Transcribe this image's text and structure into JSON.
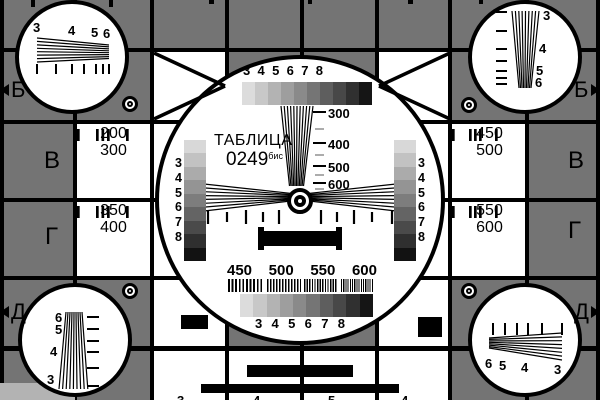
{
  "card": {
    "title": "ТАБЛИЦА",
    "number": "0249",
    "suffix": "бис",
    "bg_gray": "#747474",
    "light_strip_gray": "#b3b3b3",
    "line_black": "#000000",
    "cell_white": "#ffffff"
  },
  "scales": {
    "top_labels": [
      "3",
      "4",
      "5",
      "6",
      "7",
      "8"
    ],
    "bottom_labels": [
      "3",
      "4",
      "5",
      "6",
      "7",
      "8"
    ],
    "left_labels": [
      "3",
      "4",
      "5",
      "6",
      "7",
      "8"
    ],
    "right_labels": [
      "3",
      "4",
      "5",
      "6",
      "7",
      "8"
    ],
    "gray_steps_h": [
      "#dcdcdc",
      "#c8c8c8",
      "#b3b3b3",
      "#9e9e9e",
      "#8a8a8a",
      "#757575",
      "#5e5e5e",
      "#484848",
      "#303030",
      "#151515"
    ],
    "gray_steps_v": [
      "#d8d8d8",
      "#c2c2c2",
      "#ababab",
      "#949494",
      "#7d7d7d",
      "#646464",
      "#4a4a4a",
      "#2f2f2f",
      "#121212"
    ]
  },
  "wedge_labels": {
    "l300": "300",
    "l400": "400",
    "l500": "500",
    "l600": "600"
  },
  "freq_labels": [
    "450",
    "500",
    "550",
    "600"
  ],
  "corner_circles": {
    "tl": [
      "3",
      "4",
      "5",
      "6"
    ],
    "tr": [
      "3",
      "4",
      "5",
      "6"
    ],
    "bl": [
      "6",
      "5",
      "4",
      "3"
    ],
    "br": [
      "6",
      "5",
      "4",
      "3"
    ]
  },
  "edge_letters": {
    "b_left": "Б",
    "b_right": "Б",
    "v_left": "В",
    "v_right": "В",
    "g_left": "Г",
    "g_right": "Г",
    "d_left": "Д",
    "d_right": "Д"
  },
  "side_cells": {
    "left_top_1": "200",
    "left_top_2": "300",
    "left_bot_1": "350",
    "left_bot_2": "400",
    "right_top_1": "450",
    "right_top_2": "500",
    "right_bot_1": "550",
    "right_bot_2": "600"
  },
  "bottom_edge_digits": [
    "3",
    "4",
    "5",
    "4"
  ]
}
